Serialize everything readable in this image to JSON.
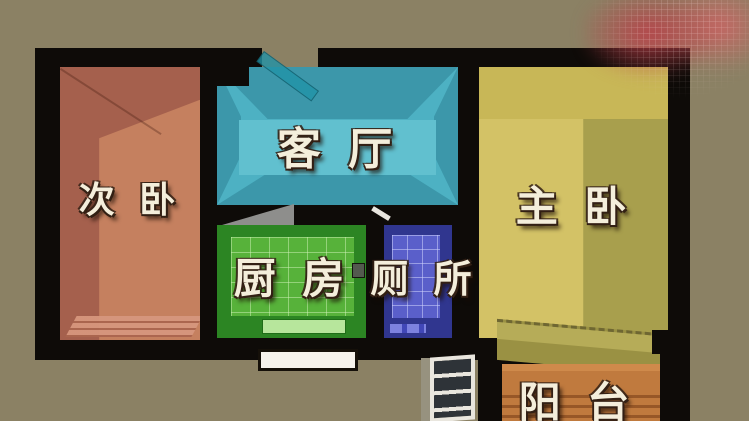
{
  "meta": {
    "scene": "apartment-floor-plan-3d",
    "background_color": "#8b8164",
    "wall_color": "#0e0b08",
    "label_text_color": "#f4eedb",
    "watermark_smudge_color": "#bc3e48"
  },
  "rooms": [
    {
      "key": "secondary-bedroom",
      "label": "次 卧",
      "floor_color": "#c5805f",
      "wall_shade_color": "#a05e4c"
    },
    {
      "key": "living-room",
      "label": "客 厅",
      "floor_color": "#4fb3c4",
      "wall_shade_color": "#3a93a6"
    },
    {
      "key": "kitchen",
      "label": "厨 房",
      "floor_color": "#57b23a",
      "wall_shade_color": "#2c8523"
    },
    {
      "key": "toilet",
      "label": "厕 所",
      "floor_color": "#5a5fca",
      "wall_shade_color": "#30368f"
    },
    {
      "key": "master-bedroom",
      "label": "主 卧",
      "floor_color": "#d3c266",
      "wall_shade_color": "#a89f4d"
    },
    {
      "key": "balcony",
      "label": "阳 台",
      "floor_color": "#c07a3e",
      "wall_shade_color": "#985e2b"
    }
  ],
  "fixtures": {
    "bottom_window": "window",
    "balcony_door": "glass-door",
    "living_room_door": "door-leaf"
  }
}
